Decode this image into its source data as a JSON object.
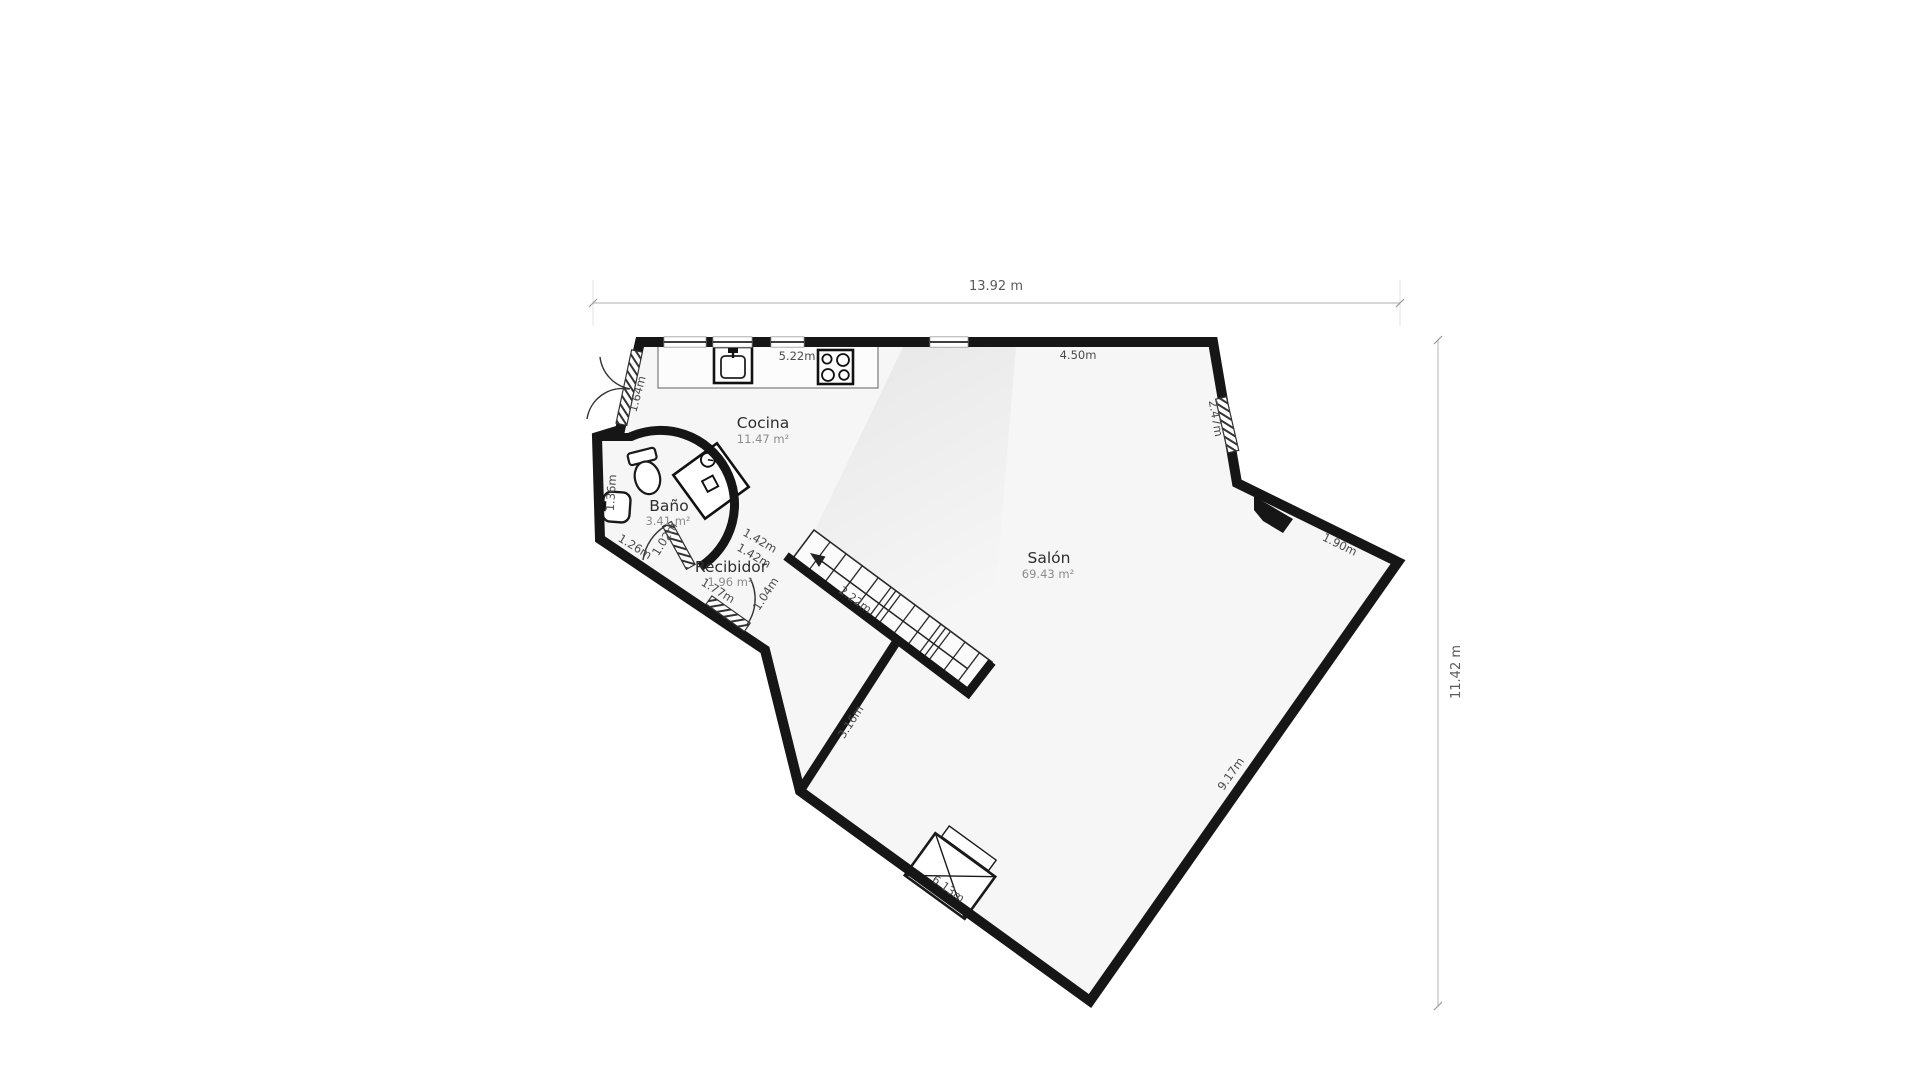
{
  "floor_plan": {
    "overall": {
      "width_label": "13.92 m",
      "height_label": "11.42 m"
    },
    "rooms": {
      "cocina": {
        "name": "Cocina",
        "area": "11.47 m²"
      },
      "bano": {
        "name": "Baño",
        "area": "3.41 m²"
      },
      "recibidor": {
        "name": "Recibidor",
        "area": "1.96 m²"
      },
      "salon": {
        "name": "Salón",
        "area": "69.43 m²"
      }
    },
    "walls": {
      "top_window_wall": "5.22m",
      "top_right_wall": "4.50m",
      "entry_double_door_wall": "1.64m",
      "ne_window_wall": "2.47m",
      "ne_corner_wall": "1.90m",
      "se_wall": "9.17m",
      "bottom_wall": "6.13m",
      "sw_wing_wall": "3.16m",
      "stairs_length": "2.22m",
      "recibidor_opening_a": "1.42m",
      "recibidor_opening_b": "1.42m",
      "recibidor_se_segment": "1.04m",
      "entry_wall": "1.77m",
      "bano_sw_wall": "1.26m",
      "bano_door": "1.02m",
      "bano_west_wall": "1.36m"
    },
    "colors": {
      "wall": "#161616",
      "floor": "#f6f6f6",
      "dim_line": "#c9c9c9",
      "dim_text": "#4a4a4a",
      "room_text": "#2e2e2e",
      "area_text": "#8c8c8c"
    }
  }
}
